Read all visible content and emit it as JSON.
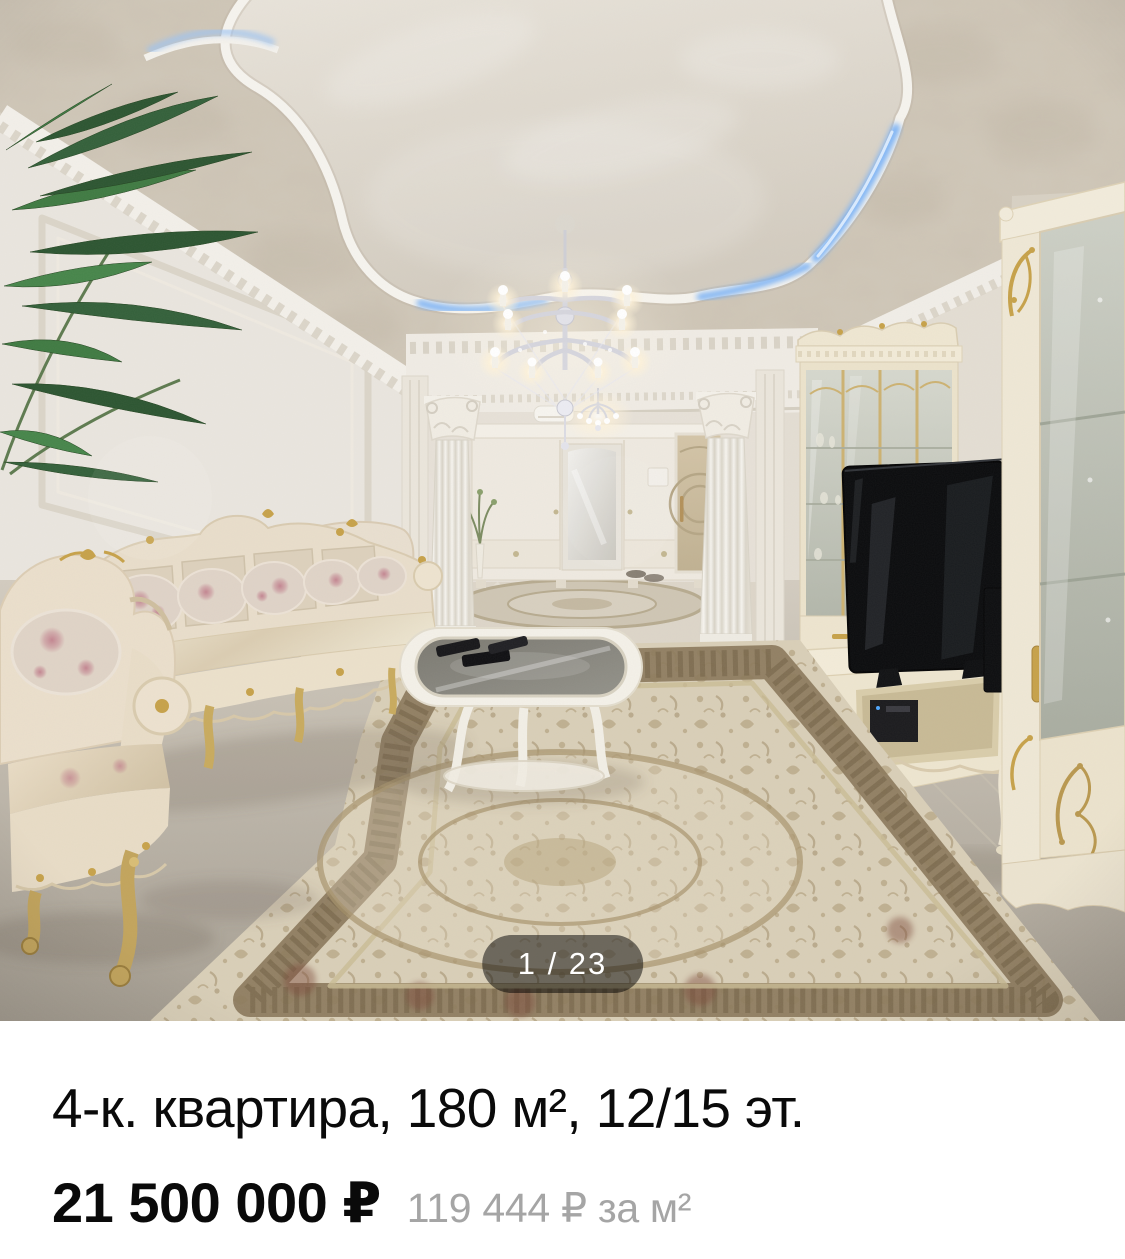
{
  "page": {
    "background_color": "#ffffff"
  },
  "gallery": {
    "counter_label": "1 / 23",
    "current_photo": 1,
    "total_photos": 23
  },
  "listing": {
    "title": "4-к. квартира, 180 м², 12/15 эт.",
    "price": "21 500 000 ₽",
    "price_per_area": "119 444 ₽ за м²"
  },
  "colors": {
    "badge_background": "rgba(0,0,0,0.5)",
    "badge_text": "#ffffff",
    "title_text": "#0a0a0a",
    "price_text": "#0a0a0a",
    "price_per_area_text": "#a5a5a5"
  }
}
